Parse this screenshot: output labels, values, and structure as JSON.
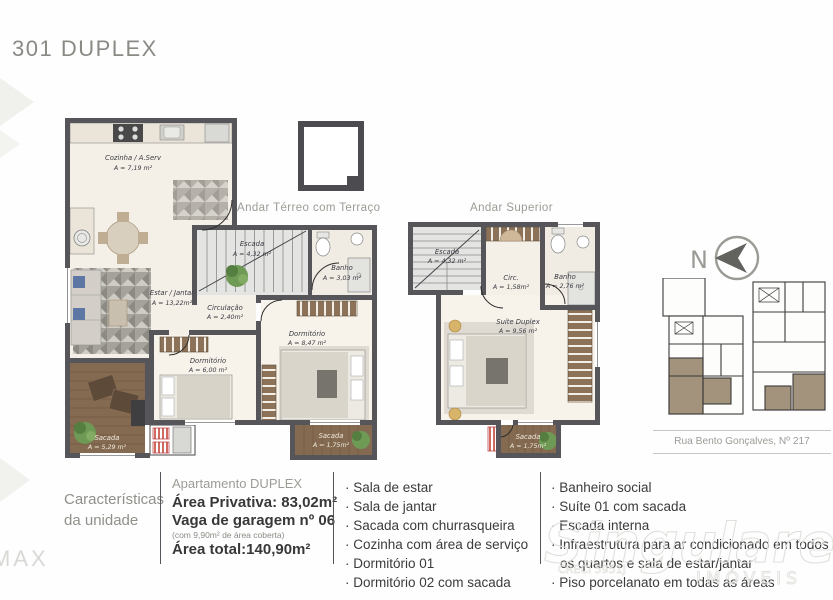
{
  "title": "301 DUPLEX",
  "plans": [
    {
      "name": "Andar Térreo com Terraço",
      "rooms": [
        {
          "label": "Cozinha / A.Serv",
          "area": "A = 7,19 m²"
        },
        {
          "label": "Escada",
          "area": "A = 4,32 m²"
        },
        {
          "label": "Banho",
          "area": "A = 3,03 m²"
        },
        {
          "label": "Estar / Jantar",
          "area": "A = 13,22m²"
        },
        {
          "label": "Circulação",
          "area": "A = 2,40m²"
        },
        {
          "label": "Dormitório",
          "area": "A = 6,00 m²"
        },
        {
          "label": "Dormitório",
          "area": "A = 8,47 m²"
        },
        {
          "label": "Sacada",
          "area": "A = 5,29 m²"
        },
        {
          "label": "Sacada",
          "area": "A = 1,75m²"
        }
      ]
    },
    {
      "name": "Andar Superior",
      "rooms": [
        {
          "label": "Escada",
          "area": "A = 4,32 m²"
        },
        {
          "label": "Circ.",
          "area": "A = 1,58m²"
        },
        {
          "label": "Banho",
          "area": "A = 2,76 m²"
        },
        {
          "label": "Suíte Duplex",
          "area": "A = 9,56 m²"
        },
        {
          "label": "Sacada",
          "area": "A = 1,75m²"
        }
      ]
    }
  ],
  "compass": {
    "north_label": "N"
  },
  "site": {
    "street": "Rua Bento Gonçalves, Nº 217"
  },
  "details": {
    "heading_line1": "Características",
    "heading_line2": "da unidade",
    "unit_type": "Apartamento DUPLEX",
    "private_area": "Área Privativa: 83,02m²",
    "garage": "Vaga de garagem nº 06",
    "garage_note": "(com 9,90m² de área coberta)",
    "total_area": "Área total:140,90m²",
    "features_col1": [
      "Sala de estar",
      "Sala de jantar",
      "Sacada com churrasqueira",
      "Cozinha com área de serviço",
      "Dormitório 01",
      "Dormitório 02 com sacada"
    ],
    "features_col2": [
      "Banheiro social",
      "Suíte 01 com sacada",
      "Escada interna",
      "Infraestrutura para ar condicionado em todos os quartos e sala de estar/jantar",
      "Piso porcelanato em todas as áreas"
    ]
  },
  "watermarks": {
    "corner_text": "MAX",
    "brand": "Singulare",
    "brand_type": "IMÓVEIS",
    "brand_creci": "CRECI 5951J"
  },
  "colors": {
    "wall": "#56565a",
    "wood": "#846a50",
    "accent_tan": "#a3927c",
    "text_gray": "#9b9b95",
    "text_dark": "#3e3e3e"
  }
}
